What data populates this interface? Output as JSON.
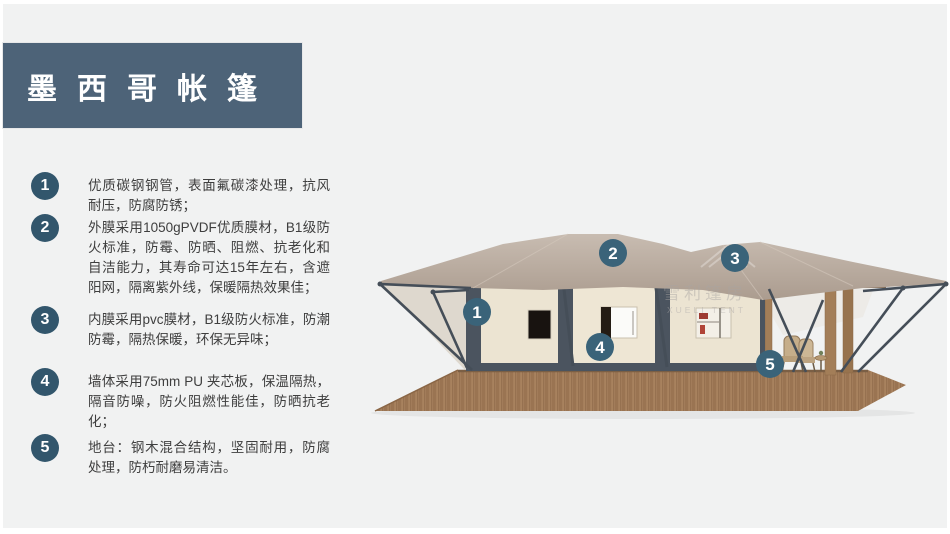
{
  "slide": {
    "title": "墨西哥帐篷",
    "background_color": "#f1f2f2",
    "banner_color": "#4d6378"
  },
  "features": [
    {
      "num": "1",
      "text": "优质碳钢钢管，表面氟碳漆处理，抗风耐压，防腐防锈；"
    },
    {
      "num": "2",
      "text": "外膜采用1050gPVDF优质膜材，B1级防火标准，防霉、防晒、阻燃、抗老化和自洁能力，其寿命可达15年左右，含遮阳网，隔离紫外线，保暖隔热效果佳；"
    },
    {
      "num": "3",
      "text": "内膜采用pvc膜材，B1级防火标准，防潮防霉，隔热保暖，环保无异味；"
    },
    {
      "num": "4",
      "text": "墙体采用75mm PU 夹芯板，保温隔热，隔音防噪，防火阻燃性能佳，防晒抗老化；"
    },
    {
      "num": "5",
      "text": "地台：钢木混合结构，坚固耐用，防腐处理，防朽耐磨易清洁。"
    }
  ],
  "diagram": {
    "markers": [
      {
        "num": "1"
      },
      {
        "num": "2"
      },
      {
        "num": "3"
      },
      {
        "num": "4"
      },
      {
        "num": "5"
      }
    ],
    "watermark": {
      "line1": "雪利篷房",
      "line2": "XUELI TENT"
    },
    "colors": {
      "marker": "#3a6379",
      "roof": "#bcafa3",
      "wall": "#ece4d2",
      "frame": "#4b545f",
      "deck": "#a8825e",
      "pole": "#454e58",
      "wood_post": "#a37e58"
    }
  }
}
